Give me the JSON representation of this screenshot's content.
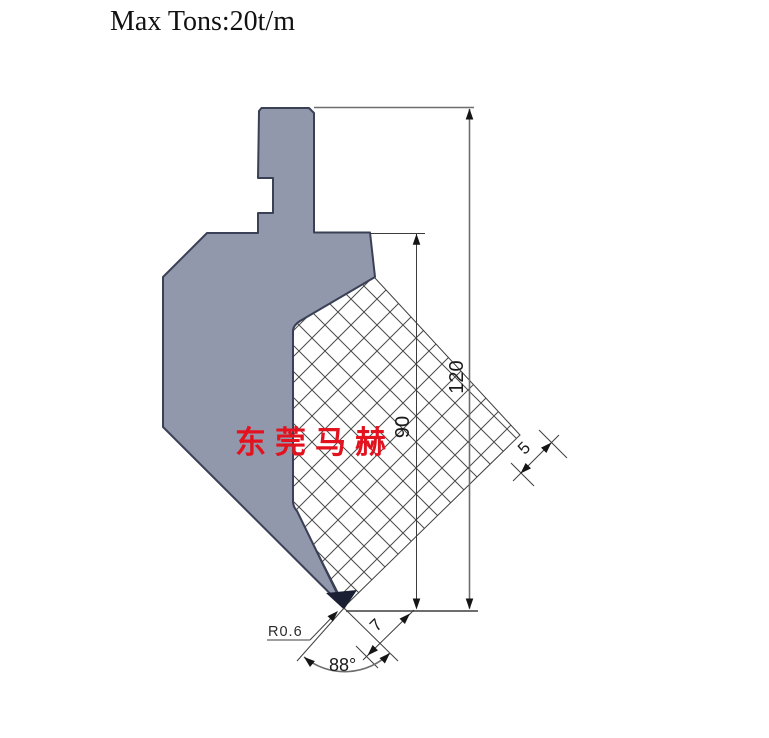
{
  "header": {
    "max_tons_label": "Max Tons:20t/m"
  },
  "watermark": {
    "text": "东莞马赫",
    "color": "#e2131e"
  },
  "drawing": {
    "type": "press-brake-punch-cross-section",
    "dims": {
      "overall_height": "120",
      "body_height": "90",
      "neck_width": "5",
      "tip_length": "7",
      "tip_radius": "R0.6",
      "tip_angle": "88°"
    },
    "colors": {
      "body_fill": "#9298ac",
      "body_stroke": "#3a4055",
      "tip_fill": "#1b1f33",
      "dim_gray": "#6e6e6e",
      "dim_dark": "#3c3c3c",
      "hatch_line": "#4a4a4a"
    }
  }
}
